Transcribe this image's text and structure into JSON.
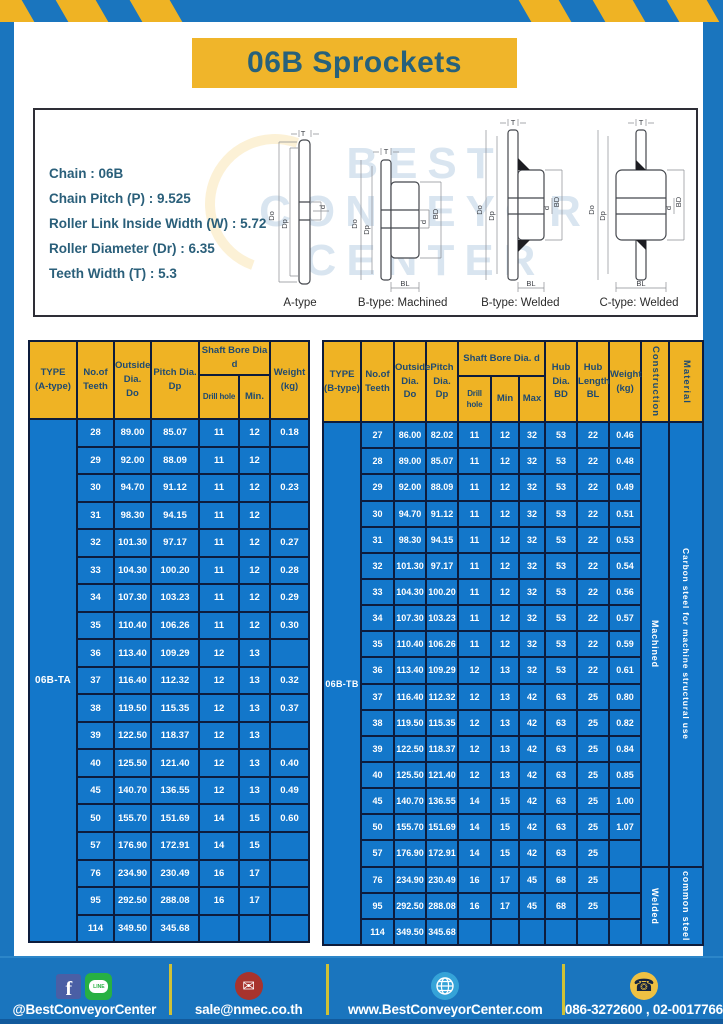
{
  "title": "06B Sprockets",
  "specs": {
    "lines": [
      "Chain : 06B",
      "Chain Pitch (P) : 9.525",
      "Roller Link Inside Width (W) : 5.72",
      "Roller Diameter (Dr) : 6.35",
      "Teeth Width (T) : 5.3"
    ]
  },
  "watermark": {
    "line1": "BEST",
    "line2": "CONVEYOR",
    "line3": "CENTER"
  },
  "diagram": {
    "captions": [
      "A-type",
      "B-type: Machined",
      "B-type: Welded",
      "C-type: Welded"
    ],
    "dims": {
      "T": "T",
      "Do": "Do",
      "Dp": "Dp",
      "d": "d",
      "BD": "BD",
      "BL": "BL"
    }
  },
  "colors": {
    "frame_blue": "#1A75BE",
    "cell_blue": "#1377CA",
    "accent_yellow": "#EFB324",
    "border_navy": "#0D1C3C",
    "title_text": "#27617B"
  },
  "table_a": {
    "headers": {
      "type": "TYPE\n(A-type)",
      "teeth": "No.of\nTeeth",
      "outside": "Outside\nDia.\nDo",
      "pitch": "Pitch Dia.\nDp",
      "shaft": "Shaft Bore Dia d",
      "drill": "Drill hole",
      "min": "Min.",
      "weight": "Weight\n(kg)"
    },
    "type_label": "06B-TA",
    "rows": [
      [
        28,
        "89.00",
        "85.07",
        "11",
        "12",
        "0.18"
      ],
      [
        29,
        "92.00",
        "88.09",
        "11",
        "12",
        ""
      ],
      [
        30,
        "94.70",
        "91.12",
        "11",
        "12",
        "0.23"
      ],
      [
        31,
        "98.30",
        "94.15",
        "11",
        "12",
        ""
      ],
      [
        32,
        "101.30",
        "97.17",
        "11",
        "12",
        "0.27"
      ],
      [
        33,
        "104.30",
        "100.20",
        "11",
        "12",
        "0.28"
      ],
      [
        34,
        "107.30",
        "103.23",
        "11",
        "12",
        "0.29"
      ],
      [
        35,
        "110.40",
        "106.26",
        "11",
        "12",
        "0.30"
      ],
      [
        36,
        "113.40",
        "109.29",
        "12",
        "13",
        ""
      ],
      [
        37,
        "116.40",
        "112.32",
        "12",
        "13",
        "0.32"
      ],
      [
        38,
        "119.50",
        "115.35",
        "12",
        "13",
        "0.37"
      ],
      [
        39,
        "122.50",
        "118.37",
        "12",
        "13",
        ""
      ],
      [
        40,
        "125.50",
        "121.40",
        "12",
        "13",
        "0.40"
      ],
      [
        45,
        "140.70",
        "136.55",
        "12",
        "13",
        "0.49"
      ],
      [
        50,
        "155.70",
        "151.69",
        "14",
        "15",
        "0.60"
      ],
      [
        57,
        "176.90",
        "172.91",
        "14",
        "15",
        ""
      ],
      [
        76,
        "234.90",
        "230.49",
        "16",
        "17",
        ""
      ],
      [
        95,
        "292.50",
        "288.08",
        "16",
        "17",
        ""
      ],
      [
        114,
        "349.50",
        "345.68",
        "",
        "",
        ""
      ]
    ]
  },
  "table_b": {
    "headers": {
      "type": "TYPE\n(B-type)",
      "teeth": "No.of\nTeeth",
      "outside": "Outside\nDia.\nDo",
      "pitch": "Pitch\nDia.\nDp",
      "shaft": "Shaft Bore Dia. d",
      "drill": "Drill hole",
      "min": "Min",
      "max": "Max",
      "hub_dia": "Hub\nDia.\nBD",
      "hub_len": "Hub\nLength\nBL",
      "weight": "Weight\n(kg)",
      "construction": "Construction",
      "material": "Material"
    },
    "type_label": "06B-TB",
    "rows": [
      [
        27,
        "86.00",
        "82.02",
        "11",
        "12",
        "32",
        "53",
        "22",
        "0.46"
      ],
      [
        28,
        "89.00",
        "85.07",
        "11",
        "12",
        "32",
        "53",
        "22",
        "0.48"
      ],
      [
        29,
        "92.00",
        "88.09",
        "11",
        "12",
        "32",
        "53",
        "22",
        "0.49"
      ],
      [
        30,
        "94.70",
        "91.12",
        "11",
        "12",
        "32",
        "53",
        "22",
        "0.51"
      ],
      [
        31,
        "98.30",
        "94.15",
        "11",
        "12",
        "32",
        "53",
        "22",
        "0.53"
      ],
      [
        32,
        "101.30",
        "97.17",
        "11",
        "12",
        "32",
        "53",
        "22",
        "0.54"
      ],
      [
        33,
        "104.30",
        "100.20",
        "11",
        "12",
        "32",
        "53",
        "22",
        "0.56"
      ],
      [
        34,
        "107.30",
        "103.23",
        "11",
        "12",
        "32",
        "53",
        "22",
        "0.57"
      ],
      [
        35,
        "110.40",
        "106.26",
        "11",
        "12",
        "32",
        "53",
        "22",
        "0.59"
      ],
      [
        36,
        "113.40",
        "109.29",
        "12",
        "13",
        "32",
        "53",
        "22",
        "0.61"
      ],
      [
        37,
        "116.40",
        "112.32",
        "12",
        "13",
        "42",
        "63",
        "25",
        "0.80"
      ],
      [
        38,
        "119.50",
        "115.35",
        "12",
        "13",
        "42",
        "63",
        "25",
        "0.82"
      ],
      [
        39,
        "122.50",
        "118.37",
        "12",
        "13",
        "42",
        "63",
        "25",
        "0.84"
      ],
      [
        40,
        "125.50",
        "121.40",
        "12",
        "13",
        "42",
        "63",
        "25",
        "0.85"
      ],
      [
        45,
        "140.70",
        "136.55",
        "14",
        "15",
        "42",
        "63",
        "25",
        "1.00"
      ],
      [
        50,
        "155.70",
        "151.69",
        "14",
        "15",
        "42",
        "63",
        "25",
        "1.07"
      ],
      [
        57,
        "176.90",
        "172.91",
        "14",
        "15",
        "42",
        "63",
        "25",
        ""
      ],
      [
        76,
        "234.90",
        "230.49",
        "16",
        "17",
        "45",
        "68",
        "25",
        ""
      ],
      [
        95,
        "292.50",
        "288.08",
        "16",
        "17",
        "45",
        "68",
        "25",
        ""
      ],
      [
        114,
        "349.50",
        "345.68",
        "",
        "",
        "",
        "",
        "",
        ""
      ]
    ],
    "groups": [
      {
        "span": 17,
        "construction": "Machined",
        "material": "Carbon steel for machine structural use"
      },
      {
        "span": 3,
        "construction": "Welded",
        "material": "common steel"
      }
    ]
  },
  "footer": {
    "social_label": "@BestConveyorCenter",
    "email": "sale@nmec.co.th",
    "website": "www.BestConveyorCenter.com",
    "phones": "086-3272600 , 02-0017766",
    "line_text": "LINE",
    "facebook_letter": "f"
  }
}
